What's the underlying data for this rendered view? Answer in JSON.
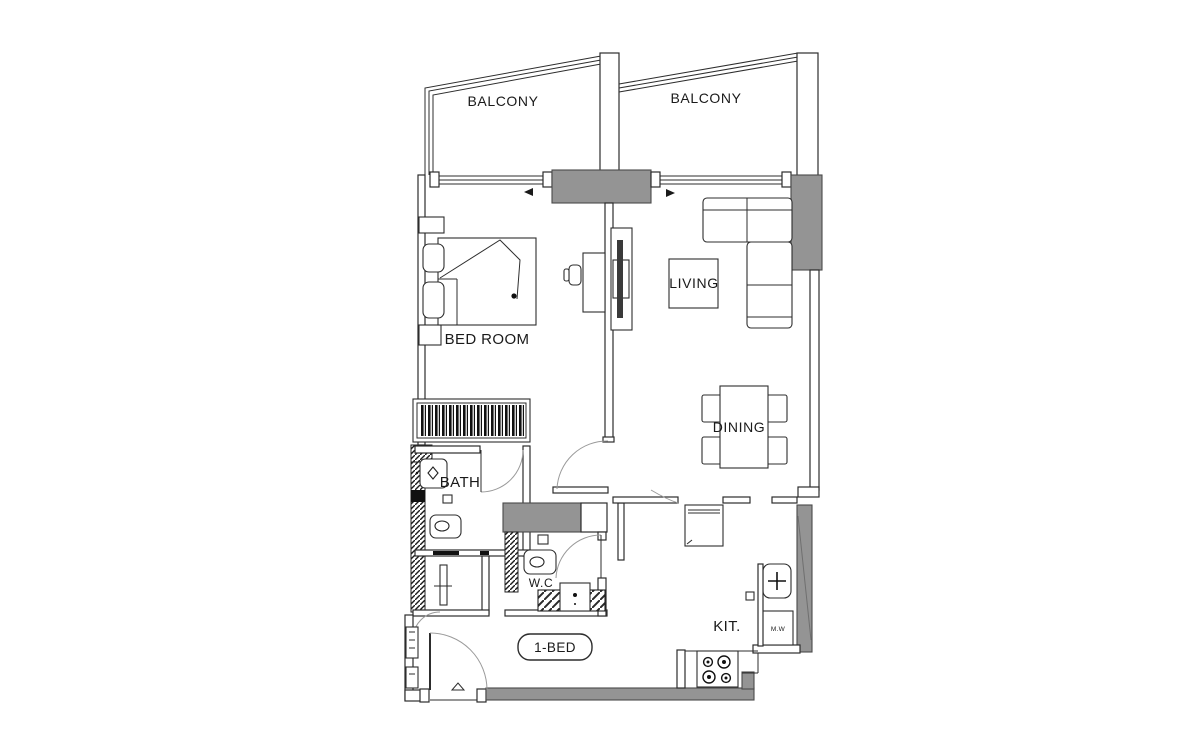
{
  "floor_plan": {
    "unit_badge": "1-BED",
    "rooms": {
      "balcony_left": "BALCONY",
      "balcony_right": "BALCONY",
      "bedroom": "BED ROOM",
      "living": "LIVING",
      "dining": "DINING",
      "bath": "BATH",
      "wc": "W.C",
      "kitchen": "KIT."
    },
    "appliances": {
      "microwave": "M.W"
    },
    "colors": {
      "background": "#ffffff",
      "line": "#2d2d2d",
      "wall_gray": "#949494",
      "text": "#1a1a1a"
    }
  }
}
